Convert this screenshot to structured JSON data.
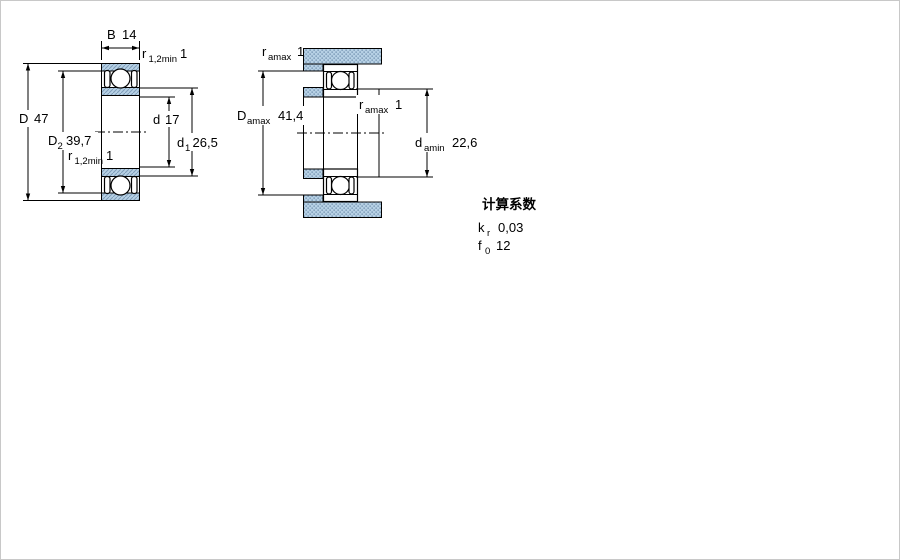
{
  "colors": {
    "line": "#000000",
    "hatch_fill": "#b7d1e5",
    "hatch_stroke": "#7e9cb8",
    "page_border": "#c8c8c8",
    "background": "#ffffff"
  },
  "left_drawing": {
    "title": "bearing cross-section with dimensions",
    "dims": {
      "width": {
        "symbol": "B",
        "value": "14"
      },
      "chamfer_top": {
        "symbol": "r",
        "sub": "1,2min",
        "value": "1"
      },
      "outer_diameter": {
        "symbol": "D",
        "value": "47"
      },
      "outer_shoulder": {
        "symbol": "D",
        "sub": "2",
        "value": "39,7"
      },
      "bore": {
        "symbol": "d",
        "value": "17"
      },
      "inner_shoulder": {
        "symbol": "d",
        "sub": "1",
        "value": "26,5"
      },
      "chamfer_bottom": {
        "symbol": "r",
        "sub": "1,2min",
        "value": "1"
      }
    }
  },
  "right_drawing": {
    "title": "abutment and fillet dimensions",
    "dims": {
      "fillet_top": {
        "symbol": "r",
        "sub": "amax",
        "value": "1"
      },
      "housing_abutment": {
        "symbol": "D",
        "sub": "amax",
        "value": "41,4"
      },
      "fillet_mid": {
        "symbol": "r",
        "sub": "amax",
        "value": "1"
      },
      "shaft_abutment": {
        "symbol": "d",
        "sub": "amin",
        "value": "22,6"
      }
    }
  },
  "calculation_factors": {
    "title": "计算系数",
    "rows": [
      {
        "symbol": "k",
        "sub": "r",
        "value": "0,03"
      },
      {
        "symbol": "f",
        "sub": "0",
        "value": "12"
      }
    ]
  }
}
